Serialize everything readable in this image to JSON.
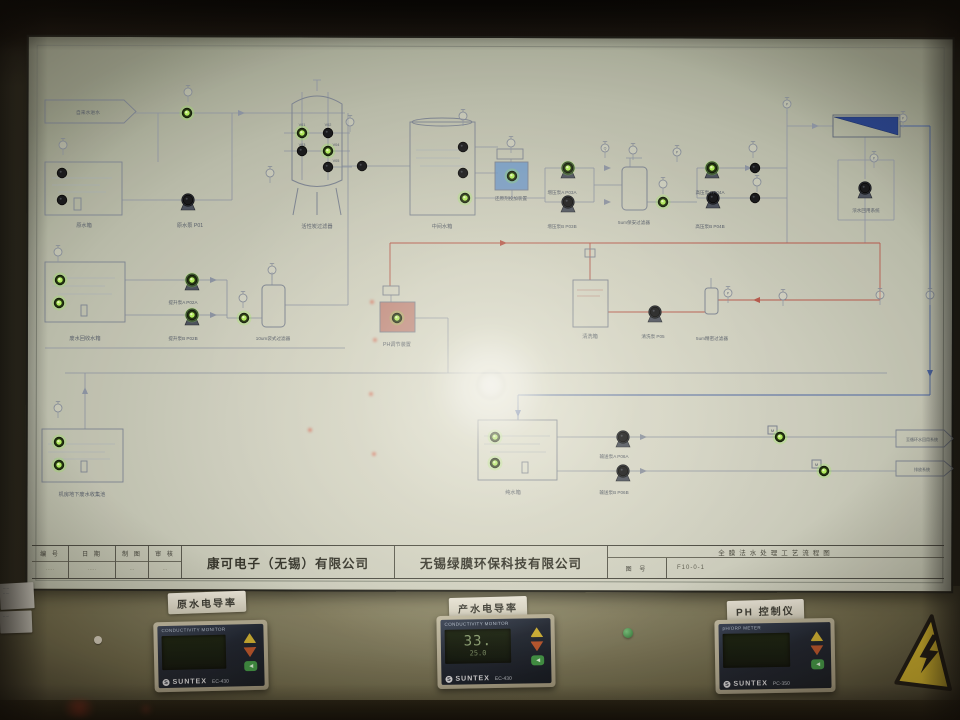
{
  "title_block": {
    "fields": [
      {
        "label": "编 号",
        "value": "·····"
      },
      {
        "label": "日 期",
        "value": "·····"
      },
      {
        "label": "制 图",
        "value": "···"
      },
      {
        "label": "审 核",
        "value": "···"
      }
    ],
    "company_left": "康可电子（无锡）有限公司",
    "company_right": "无锡绿膜环保科技有限公司",
    "drawing_title": "全膜法水处理工艺流程图",
    "drawing_no_label": "图 号",
    "drawing_no_value": "F10-0-1"
  },
  "diagram": {
    "colors": {
      "line": "#8f97a8",
      "red": "#bc5a4e",
      "blue": "#4a66a8",
      "led_on": "#b6f55e",
      "led_off": "#15161a",
      "ro_membrane": "#24418f"
    },
    "labels": [
      [
        "自来水进水",
        88,
        114,
        4.8
      ],
      [
        "原水箱",
        84,
        227
      ],
      [
        "原水泵 P01",
        190,
        227
      ],
      [
        "活性炭过滤器",
        317,
        228
      ],
      [
        "V01",
        302,
        126,
        3.8
      ],
      [
        "V02",
        328,
        126,
        3.8
      ],
      [
        "V03",
        302,
        146,
        3.8
      ],
      [
        "V04",
        336,
        146,
        3.8
      ],
      [
        "V05",
        336,
        162,
        3.8
      ],
      [
        "中间水箱",
        442,
        228
      ],
      [
        "还原剂投加装置",
        511,
        200,
        4.6
      ],
      [
        "增压泵A P03A",
        562,
        194,
        4.6
      ],
      [
        "增压泵B P03B",
        562,
        228,
        4.6
      ],
      [
        "5um保安过滤器",
        634,
        224,
        4.6
      ],
      [
        "高压泵A P04A",
        710,
        194,
        4.6
      ],
      [
        "高压泵B P04B",
        710,
        228,
        4.6
      ],
      [
        "浓水回用系统",
        866,
        212,
        4.6
      ],
      [
        "废水回收水箱",
        85,
        340
      ],
      [
        "提升泵A P02A",
        183,
        304,
        4.6
      ],
      [
        "提升泵B P02B",
        183,
        340,
        4.6
      ],
      [
        "10um袋式过滤器",
        273,
        340,
        4.6
      ],
      [
        "PH调节装置",
        397,
        346
      ],
      [
        "清洗箱",
        590,
        338
      ],
      [
        "清洗泵 P05",
        653,
        338,
        4.6
      ],
      [
        "5um精密过滤器",
        712,
        340,
        4.6
      ],
      [
        "机房地下废水收集池",
        82,
        496
      ],
      [
        "纯水箱",
        513,
        494
      ],
      [
        "输送泵A P06A",
        614,
        458,
        4.6
      ],
      [
        "输送泵B P06B",
        614,
        494,
        4.6
      ],
      [
        "至循环水回用系统",
        922,
        441,
        4.0
      ],
      [
        "排放系统",
        922,
        471,
        4.0
      ],
      [
        "M",
        772.5,
        432,
        4
      ],
      [
        "M",
        816.5,
        466,
        4
      ]
    ],
    "leds": [
      [
        187,
        113,
        1
      ],
      [
        62,
        173,
        0
      ],
      [
        62,
        200,
        0
      ],
      [
        302,
        133,
        1
      ],
      [
        328,
        133,
        0
      ],
      [
        302,
        151,
        0
      ],
      [
        328,
        151,
        1
      ],
      [
        328,
        167,
        0
      ],
      [
        362,
        166,
        0
      ],
      [
        463,
        147,
        0
      ],
      [
        463,
        173,
        0
      ],
      [
        465,
        198,
        1
      ],
      [
        512,
        176,
        1
      ],
      [
        663,
        202,
        1
      ],
      [
        755,
        168,
        0
      ],
      [
        755,
        198,
        0
      ],
      [
        60,
        280,
        1
      ],
      [
        59,
        303,
        1
      ],
      [
        244,
        318,
        1
      ],
      [
        397,
        318,
        1
      ],
      [
        59,
        442,
        1
      ],
      [
        59,
        465,
        1
      ],
      [
        495,
        437,
        1
      ],
      [
        495,
        463,
        1
      ],
      [
        780,
        437,
        1
      ],
      [
        824,
        471,
        1
      ]
    ],
    "pumps": [
      [
        188,
        200,
        0
      ],
      [
        192,
        280,
        1
      ],
      [
        192,
        315,
        1
      ],
      [
        568,
        168,
        1
      ],
      [
        568,
        202,
        0
      ],
      [
        712,
        168,
        1
      ],
      [
        713,
        198,
        0
      ],
      [
        655,
        312,
        0
      ],
      [
        623,
        437,
        0
      ],
      [
        623,
        471,
        0
      ],
      [
        865,
        188,
        0
      ]
    ],
    "gauges": [
      [
        188,
        92,
        ""
      ],
      [
        63,
        145,
        ""
      ],
      [
        270,
        173,
        ""
      ],
      [
        350,
        122,
        ""
      ],
      [
        463,
        116,
        ""
      ],
      [
        605,
        148,
        "Q"
      ],
      [
        663,
        184,
        ""
      ],
      [
        677,
        152,
        "P"
      ],
      [
        753,
        148,
        ""
      ],
      [
        757,
        182,
        ""
      ],
      [
        787,
        104,
        "P"
      ],
      [
        874,
        158,
        "P"
      ],
      [
        903,
        118,
        "P"
      ],
      [
        58,
        252,
        ""
      ],
      [
        243,
        298,
        ""
      ],
      [
        272,
        270,
        ""
      ],
      [
        511,
        143,
        ""
      ],
      [
        633,
        150,
        ""
      ],
      [
        728,
        293,
        "P"
      ],
      [
        783,
        296,
        ""
      ],
      [
        58,
        408,
        ""
      ],
      [
        880,
        295,
        ""
      ],
      [
        930,
        295,
        ""
      ]
    ]
  },
  "meters": [
    {
      "plate": "原水电导率",
      "header": "CONDUCTIVITY MONITOR",
      "logo": "S",
      "brand": "SUNTEX",
      "model": "EC-430"
    },
    {
      "plate": "产水电导率",
      "header": "CONDUCTIVITY MONITOR",
      "logo": "S",
      "brand": "SUNTEX",
      "model": "EC-430",
      "main": "33.",
      "sub": "25.0"
    },
    {
      "plate": "PH 控制仪",
      "header": "pH/ORP METER",
      "logo": "S",
      "brand": "SUNTEX",
      "model": "PC-350"
    }
  ],
  "stickers": [
    {
      "lines": [
        "·····",
        "·····"
      ]
    },
    {
      "lines": [
        "·····"
      ]
    }
  ]
}
